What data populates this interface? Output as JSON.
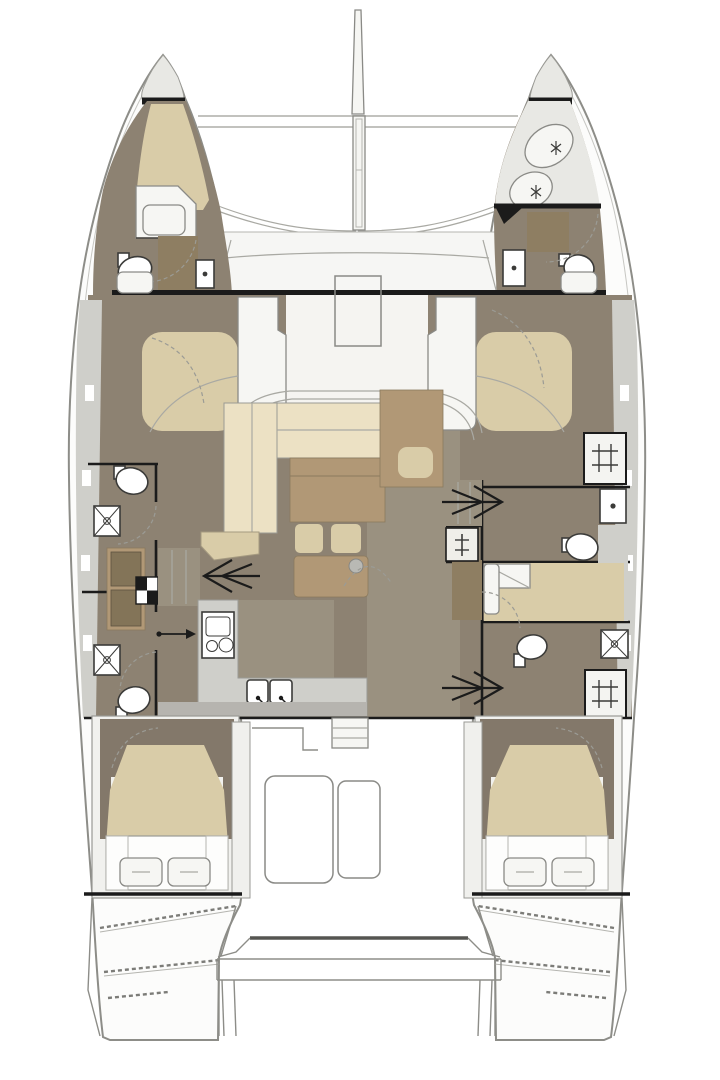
{
  "plan": {
    "type": "boat-floor-plan",
    "vessel": "sailing-catamaran",
    "view": "top-down-accommodation-plan",
    "orientation": "bow-up"
  },
  "palette": {
    "taupe": "#8d8272",
    "taupe-dark": "#83786a",
    "beige": "#d9cca8",
    "cream": "#ece1c4",
    "brown": "#b19876",
    "brown-dark": "#8e7e62",
    "gray-deck": "#cfcfca",
    "gray-band": "#b6b4af",
    "bow-gray": "#e8e8e4",
    "floor-light": "#9a9180",
    "line": "#8d8d88",
    "black": "#1b1b1b",
    "fixture": "#3b3b39",
    "white": "#fcfcfb"
  },
  "inventory": {
    "hulls": [
      "port",
      "starboard"
    ],
    "deck": [
      "bowsprit",
      "forward-crossbeam",
      "trampoline",
      "forward-cockpit",
      "sunpad-port",
      "sunpad-starboard",
      "deck-hatches",
      "aft-cockpit",
      "swim-platform",
      "transom-steps"
    ],
    "salon": [
      "l-shaped-sofa",
      "dinette-table",
      "seat-cushions",
      "coffee-table",
      "ottoman",
      "nav-cabinet"
    ],
    "galley": [
      "l-counter",
      "stove-oven",
      "double-sink"
    ],
    "cabins": [
      "port-bow-vberth-cabin",
      "starboard-bow-crew-cabin",
      "starboard-single-berth-cabin",
      "port-aft-double-cabin",
      "starboard-aft-double-cabin"
    ],
    "wet_rooms": [
      "port-bow-head",
      "starboard-bow-head",
      "port-forward-head",
      "port-forward-shower",
      "port-aft-shower",
      "port-aft-head",
      "starboard-head-with-sink",
      "starboard-aft-head",
      "deck-grate-forward",
      "deck-grate-aft"
    ],
    "companionway_arrow_count": 4
  }
}
